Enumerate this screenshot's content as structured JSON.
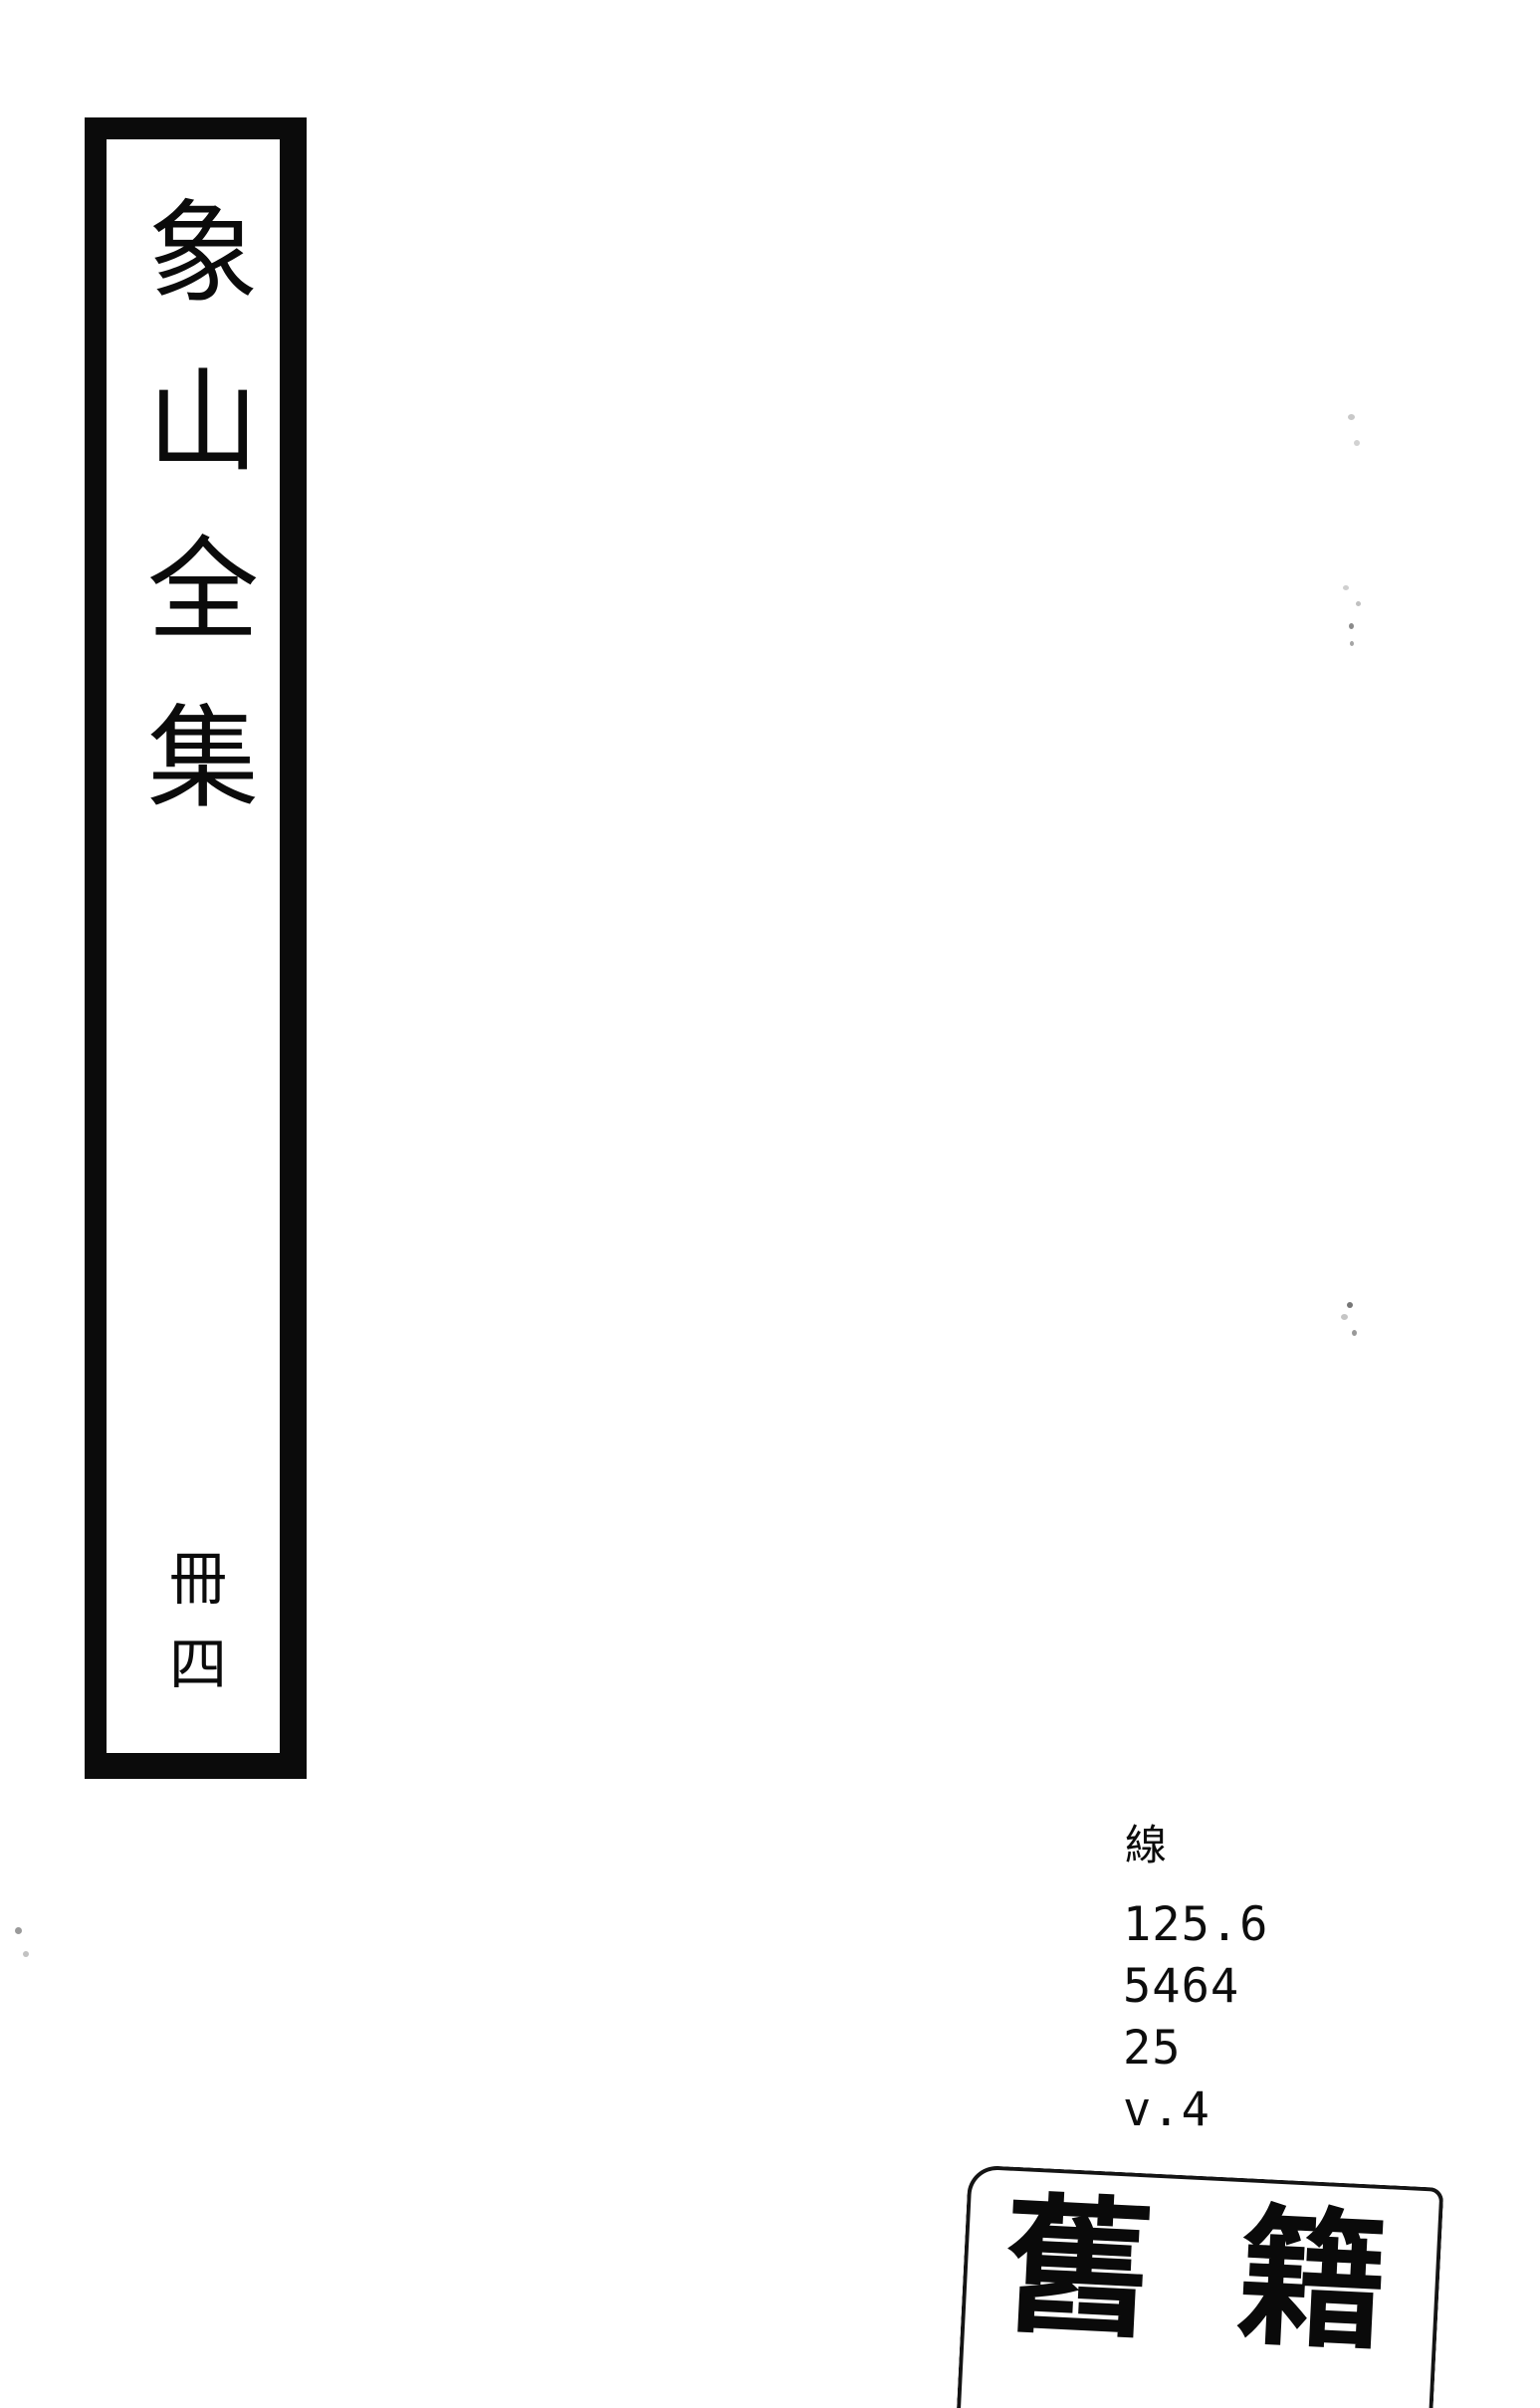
{
  "colors": {
    "paper": "#ffffff",
    "ink": "#0b0b0b"
  },
  "spine_label": {
    "title": "象山全集",
    "volume": "冊四"
  },
  "call_number": {
    "classification": "線",
    "lines": [
      "125.6",
      "5464",
      "25",
      "v.4"
    ]
  },
  "stamp": {
    "characters": [
      "舊",
      "籍"
    ]
  }
}
